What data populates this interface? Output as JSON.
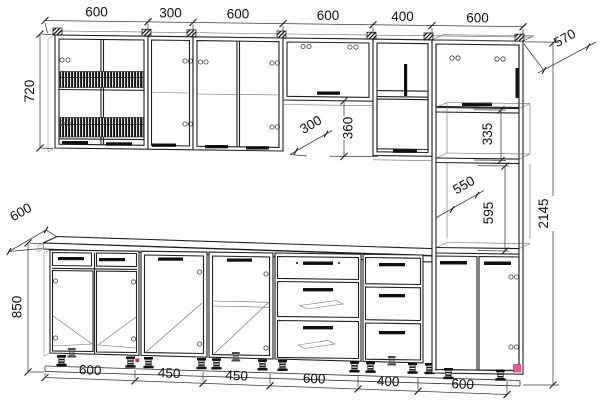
{
  "drawing": {
    "title": "kitchen-cabinet-set-elevation",
    "units": "mm",
    "dims": {
      "top": [
        "600",
        "300",
        "600",
        "600",
        "400",
        "600"
      ],
      "bottom": [
        "600",
        "450",
        "450",
        "600",
        "400",
        "600"
      ],
      "upper_height": "720",
      "base_depth": "600",
      "base_height": "850",
      "tall_depth": "570",
      "total_height": "2145",
      "wall_depth": "300",
      "flap_height": "360",
      "top_niche_height": "335",
      "niche_depth": "550",
      "niche_height": "595"
    },
    "colors": {
      "line": "#1f1f1f",
      "dim_line": "#3c3c3c",
      "accent_pink": "#ee5a96",
      "accent_red": "#d2203c",
      "background": "#ffffff"
    }
  }
}
